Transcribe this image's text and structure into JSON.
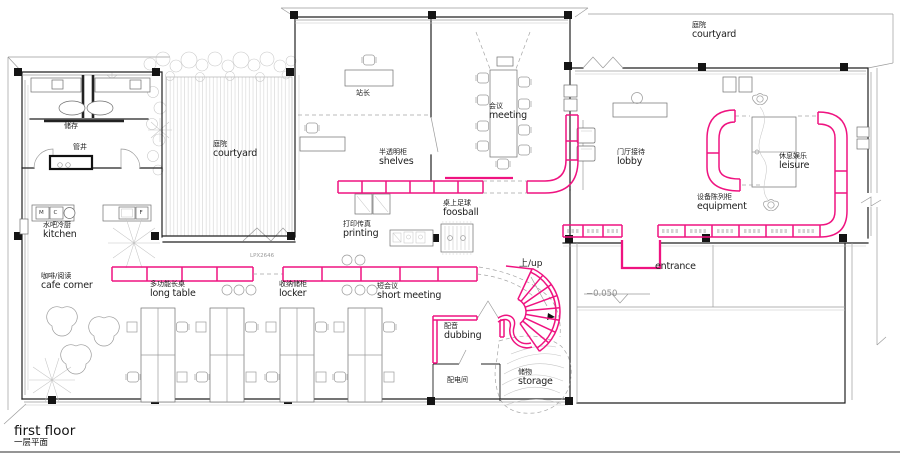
{
  "title": {
    "en": "first floor",
    "cn": "一层平面"
  },
  "colors": {
    "accent": "#ef1380",
    "wall": "#222222",
    "light": "#9b9b9b"
  },
  "rooms": {
    "storage_closet": {
      "cn": "储存"
    },
    "pipe_shaft": {
      "cn": "管井"
    },
    "courtyard_west": {
      "cn": "庭院",
      "en": "courtyard"
    },
    "courtyard_east": {
      "cn": "庭院",
      "en": "courtyard"
    },
    "station_master": {
      "cn": "站长"
    },
    "meeting": {
      "cn": "会议",
      "en": "meeting"
    },
    "shelves": {
      "cn": "半透明柜",
      "en": "shelves"
    },
    "lobby": {
      "cn": "门厅接待",
      "en": "lobby"
    },
    "leisure": {
      "cn": "休息娱乐",
      "en": "leisure"
    },
    "equipment": {
      "cn": "设备陈列柜",
      "en": "equipment"
    },
    "foosball": {
      "cn": "桌上足球",
      "en": "foosball"
    },
    "printing": {
      "cn": "打印传真",
      "en": "printing"
    },
    "kitchen": {
      "cn": "水吧冷厨",
      "en": "kitchen"
    },
    "cafe_corner": {
      "cn": "咖啡/阅读",
      "en": "cafe corner"
    },
    "long_table": {
      "cn": "多功能长桌",
      "en": "long table"
    },
    "locker": {
      "cn": "收纳储柜",
      "en": "locker"
    },
    "short_meeting": {
      "cn": "短会议",
      "en": "short meeting"
    },
    "dubbing": {
      "cn": "配音",
      "en": "dubbing"
    },
    "electrical_room": {
      "cn": "配电间"
    },
    "stair_storage": {
      "cn": "储物",
      "en": "storage"
    }
  },
  "markers": {
    "up": "上/up",
    "entrance": "entrance",
    "level": "−0.050",
    "door_code": "LPX2646"
  },
  "appliance_letters": {
    "m": "M",
    "c": "C",
    "f": "F"
  }
}
